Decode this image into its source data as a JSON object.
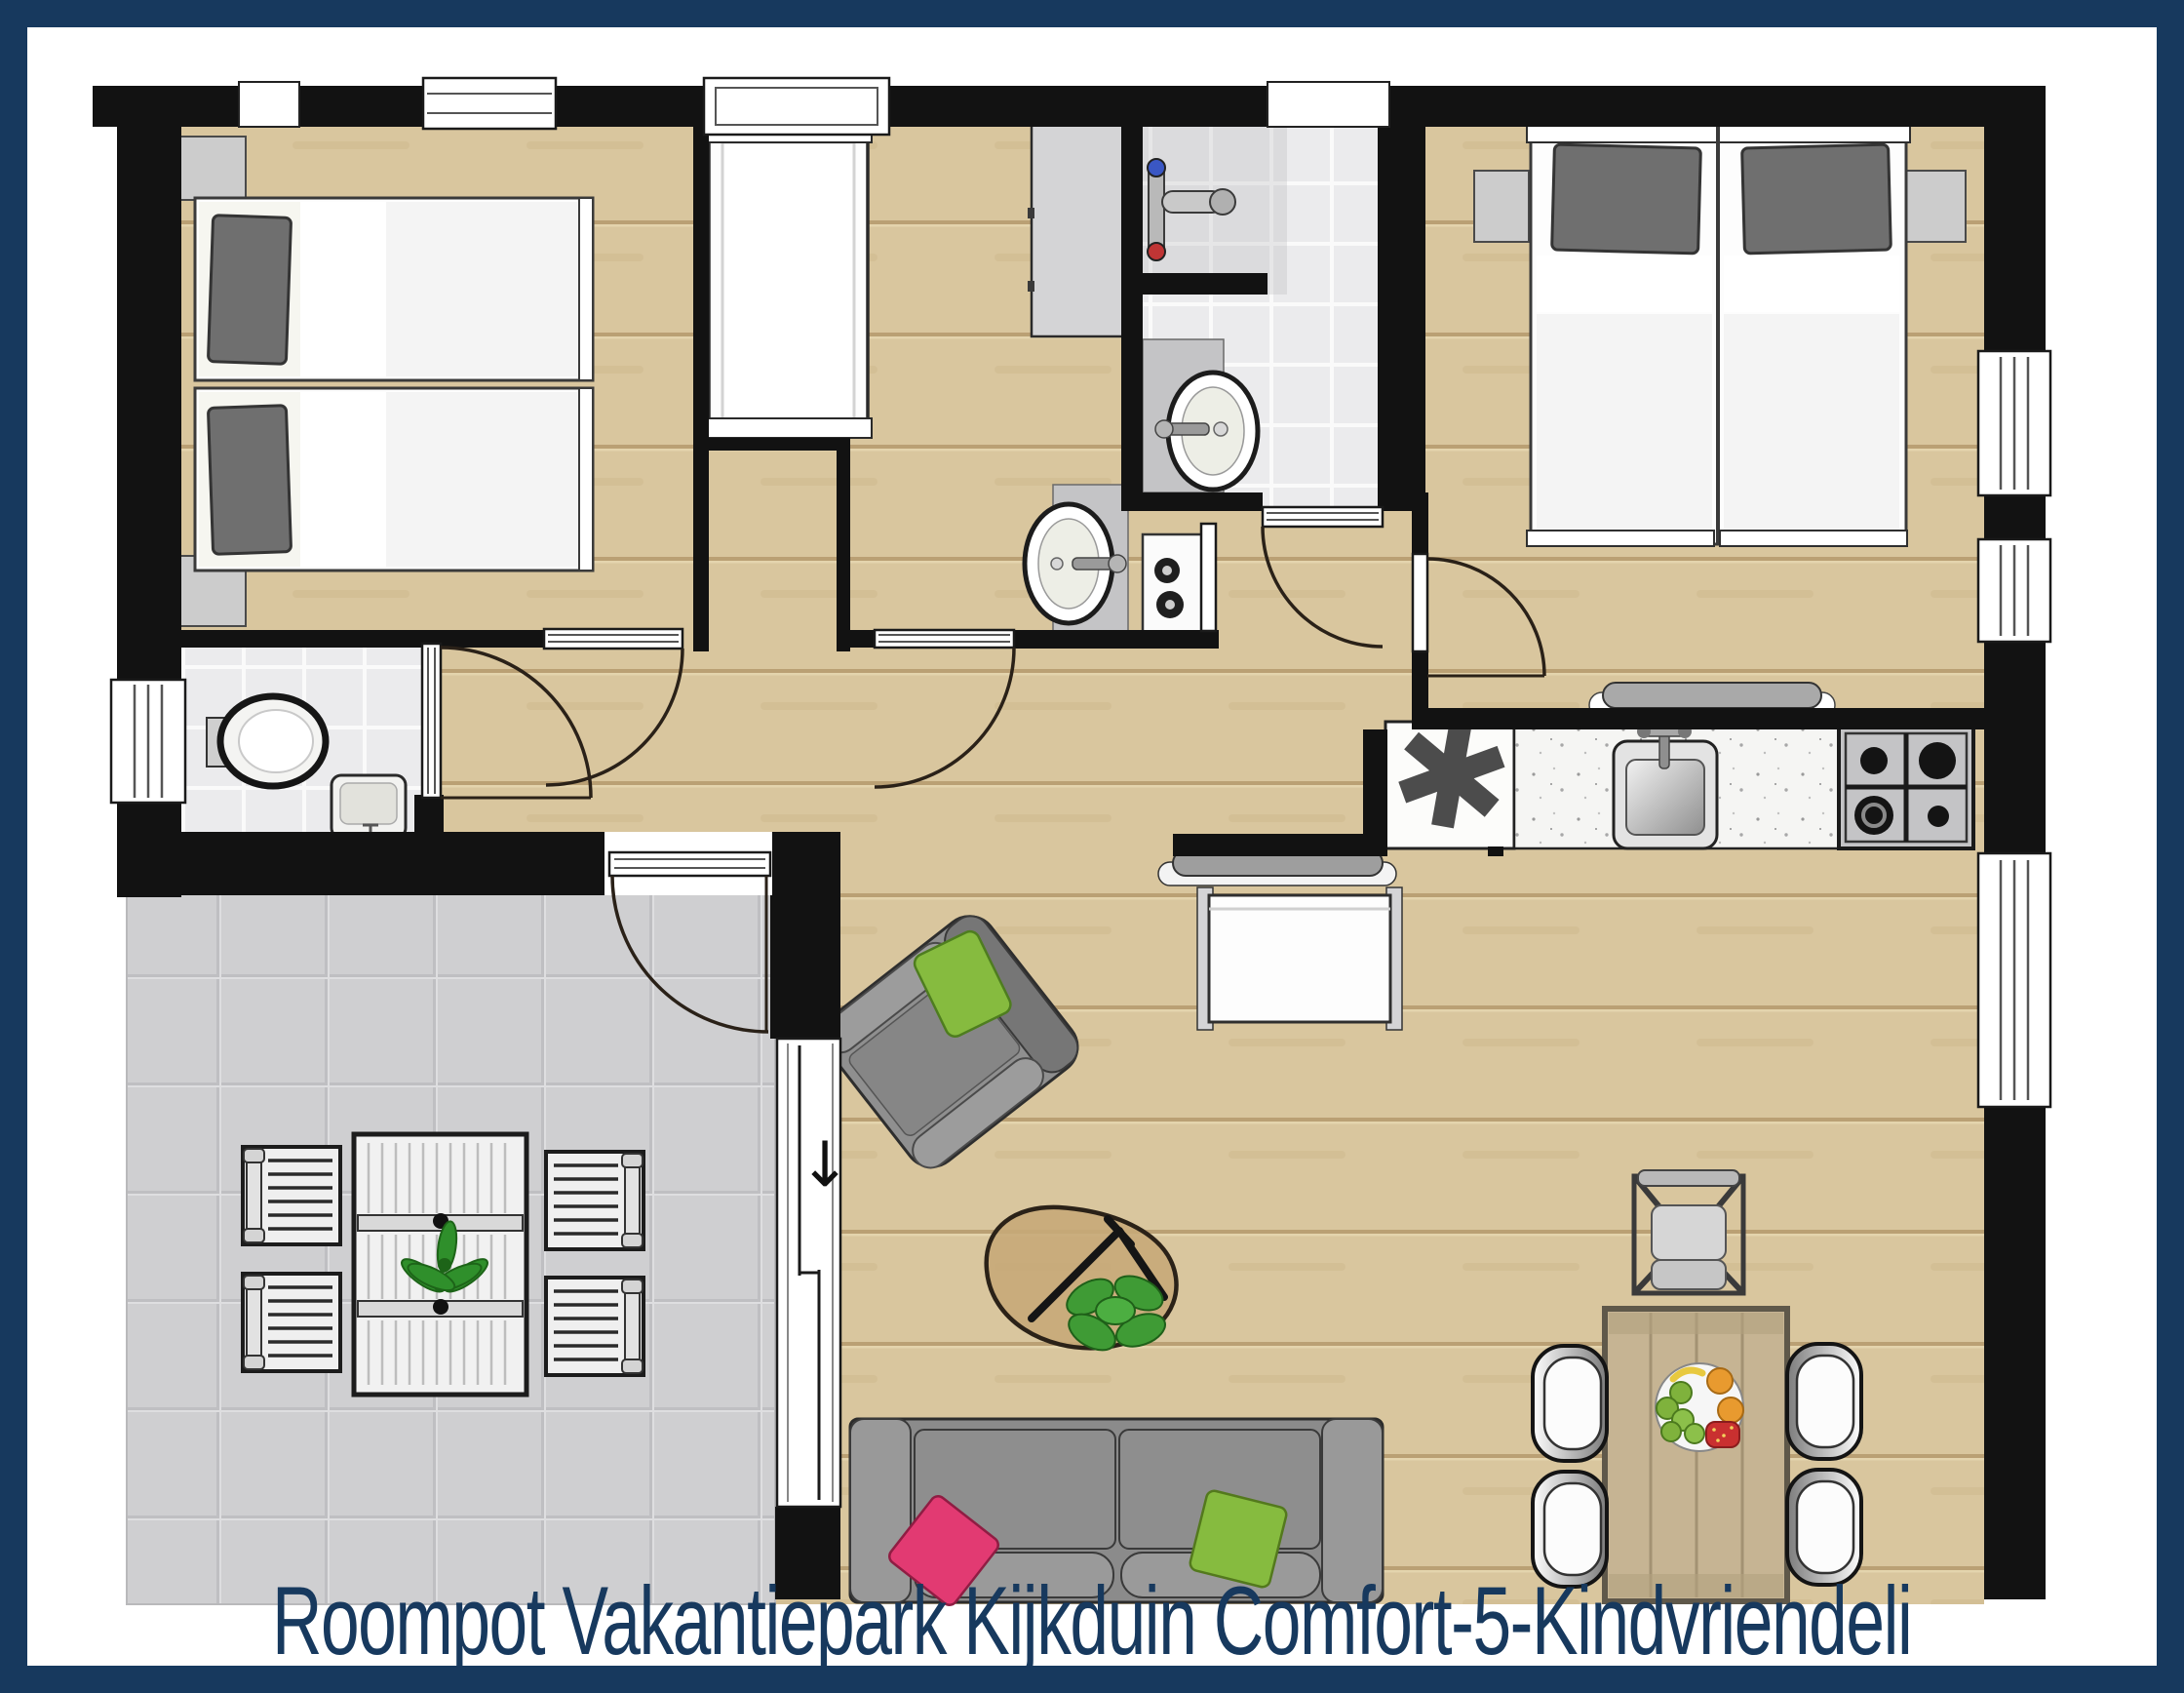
{
  "caption": {
    "text": "Roompot Vakantiepark Kijkduin Comfort-5-Kindvriendeli"
  },
  "icons": {
    "appliance_asterisk": "✱",
    "slide_direction_arrow": "↓"
  },
  "palette": {
    "frame_navy": "#17395e",
    "caption_navy": "#17395e",
    "wall_black": "#121212",
    "wood_floor": "#d9c69e",
    "wood_plank_line": "#b5996c",
    "terrace_tile_gray": "#cfcfd1",
    "bathroom_tile": "#ebebed",
    "counter_gray": "#c4c4c6",
    "sofa_gray": "#8b8b8b",
    "cushion_green": "#86bb3f",
    "cushion_pink": "#e23a72",
    "plant_green": "#3f9b35",
    "dining_table_wood": "#c6b493",
    "shower_hot_red": "#c03535",
    "shower_cold_blue": "#3a57c4"
  }
}
